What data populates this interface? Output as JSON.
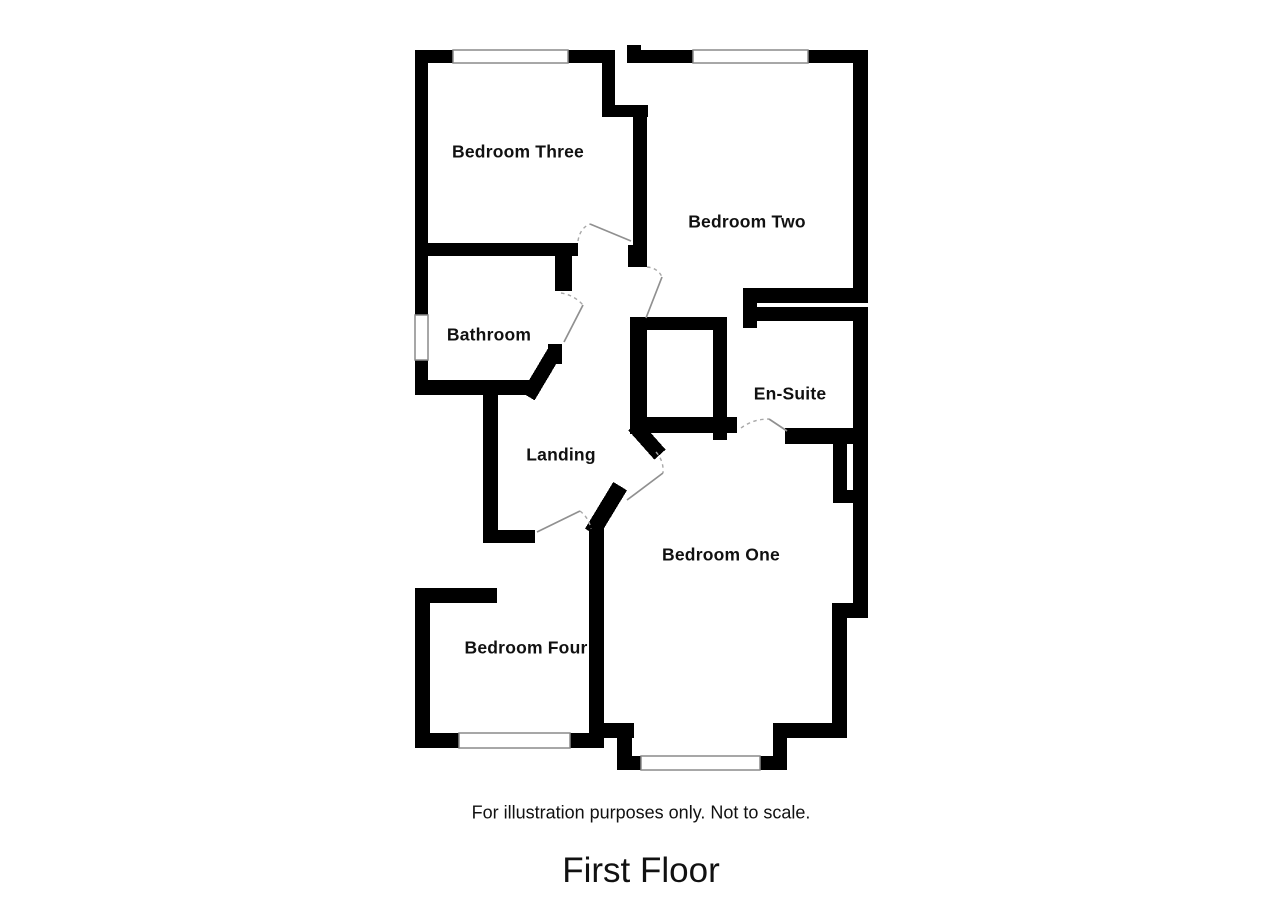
{
  "plan": {
    "rooms": [
      {
        "label": "Bedroom Three"
      },
      {
        "label": "Bedroom Two"
      },
      {
        "label": "Bathroom"
      },
      {
        "label": "En-Suite"
      },
      {
        "label": "Landing"
      },
      {
        "label": "Bedroom One"
      },
      {
        "label": "Bedroom Four"
      }
    ],
    "note": "For illustration purposes only. Not to scale.",
    "title": "First Floor",
    "colors": {
      "wall": "#000000",
      "background": "#ffffff",
      "door_line": "#909090",
      "window_line": "#8a8a8a"
    }
  }
}
